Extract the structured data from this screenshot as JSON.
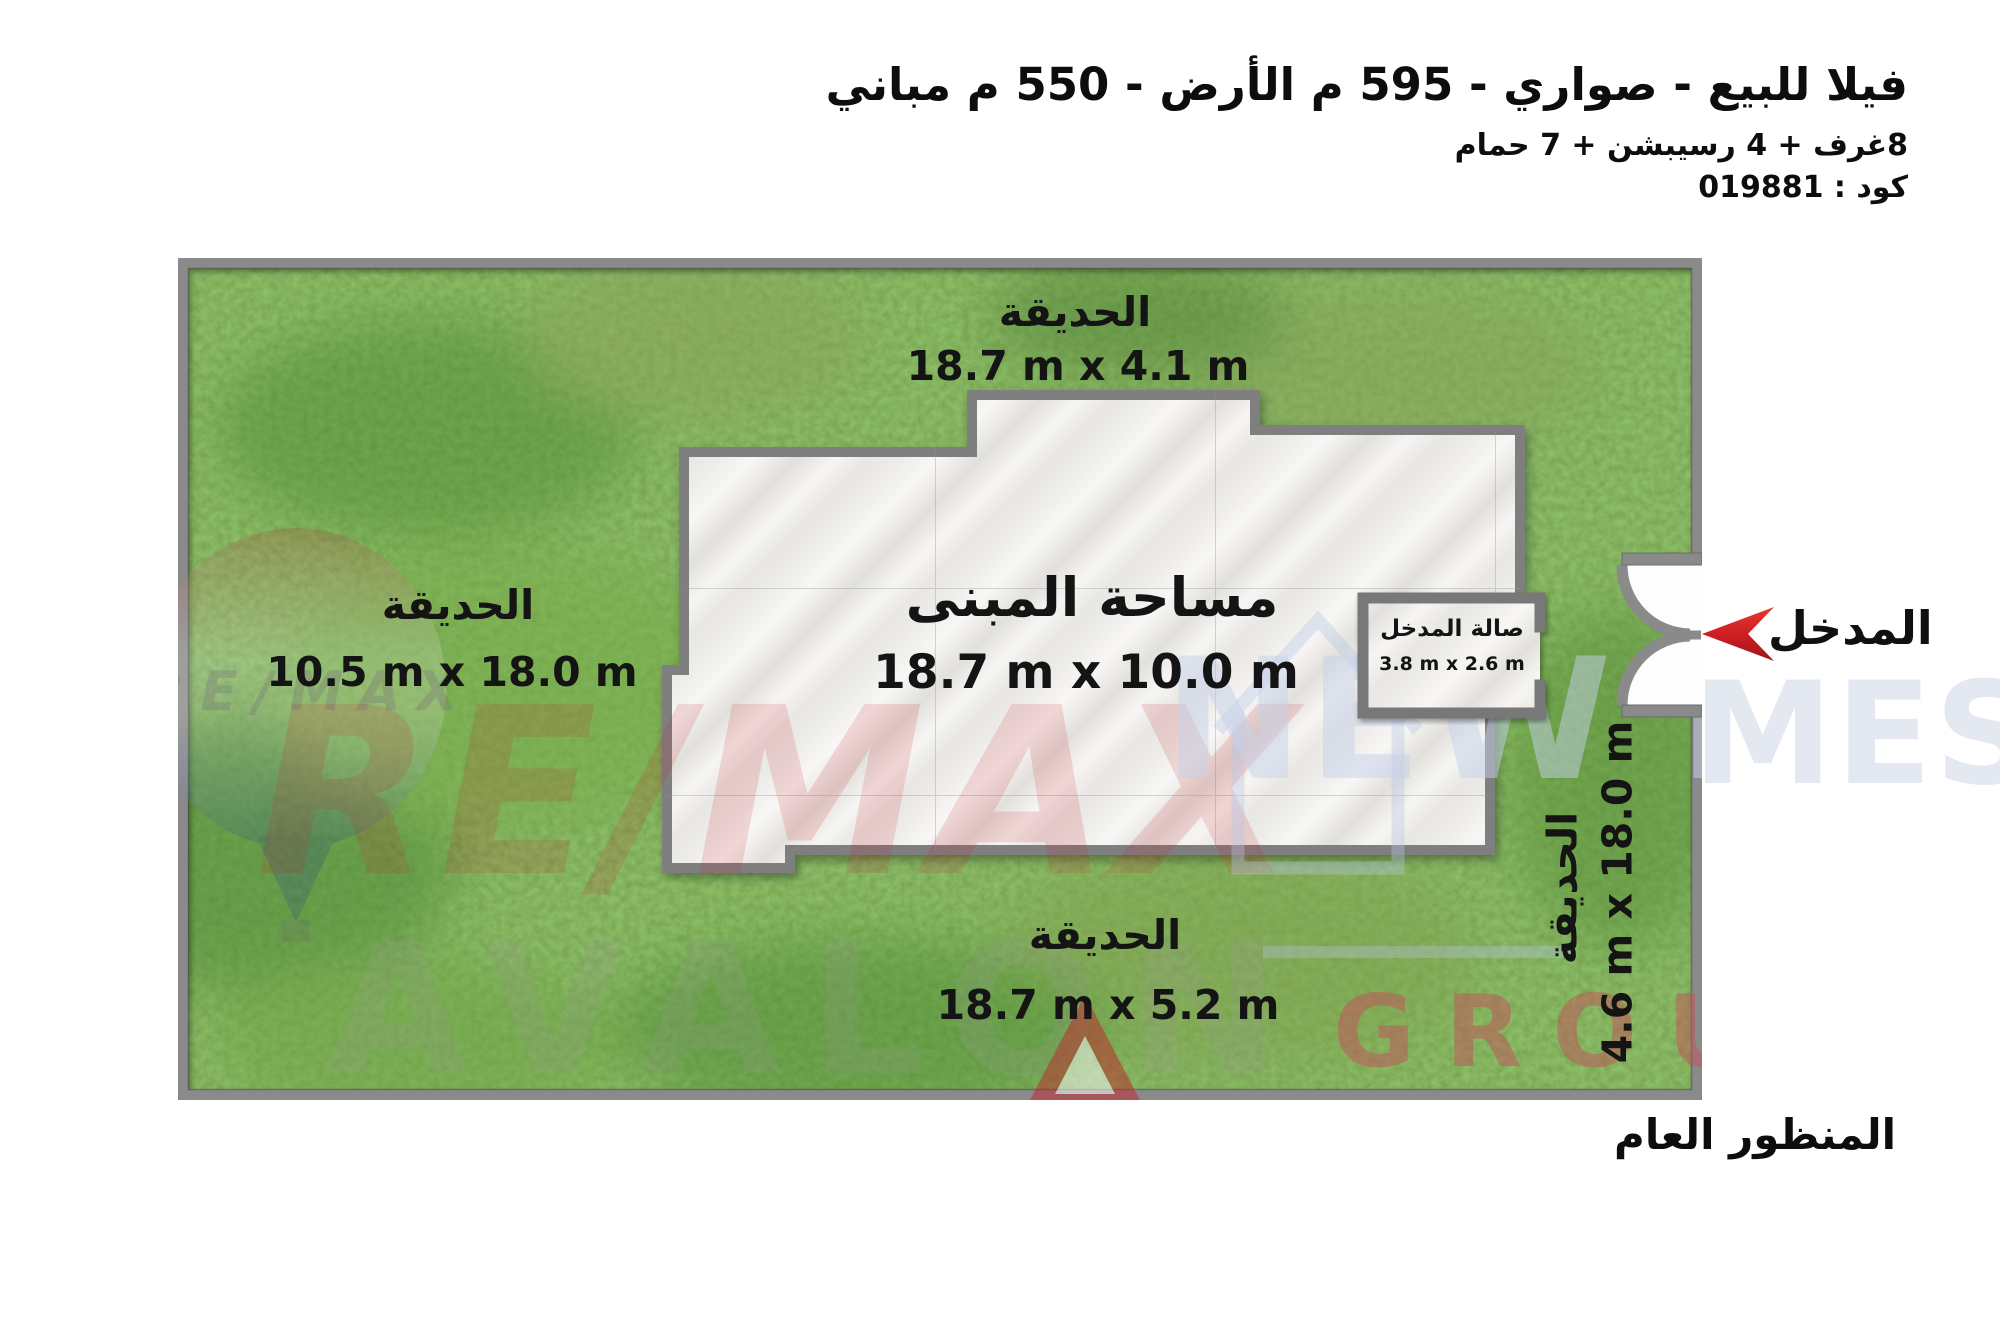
{
  "header": {
    "title": "فيلا للبيع - صواري - 595 م الأرض - 550 م مباني",
    "specs": "8غرف + 4 رسيبشن + 7 حمام",
    "code": "كود : 019881"
  },
  "plan": {
    "garden_top": {
      "name": "الحديقة",
      "size": "18.7 m x 4.1 m"
    },
    "garden_left": {
      "name": "الحديقة",
      "size": "10.5 m x 18.0 m"
    },
    "garden_bottom": {
      "name": "الحديقة",
      "size": "18.7 m x 5.2 m"
    },
    "garden_right": {
      "name": "الحديقة",
      "size": "4.6 m x 18.0 m"
    },
    "building": {
      "name": "مساحة المبنى",
      "size": "18.7 m x 10.0 m"
    },
    "entrance_hall": {
      "name": "صالة المدخل",
      "size": "3.8 m x 2.6 m"
    },
    "entrance_label": "المدخل",
    "caption": "المنظور العام"
  },
  "watermarks": {
    "remax": "RE/MAX",
    "remax_small": "RE/MAX",
    "avalon": "AVALON",
    "new_homes_left": "NEW H",
    "new_homes_right": "MES",
    "group": "GROUP"
  },
  "colors": {
    "grass": "#62993a",
    "wall": "#8a8a8a",
    "marble": "#efeeec",
    "arrow_red": "#d4252a"
  }
}
